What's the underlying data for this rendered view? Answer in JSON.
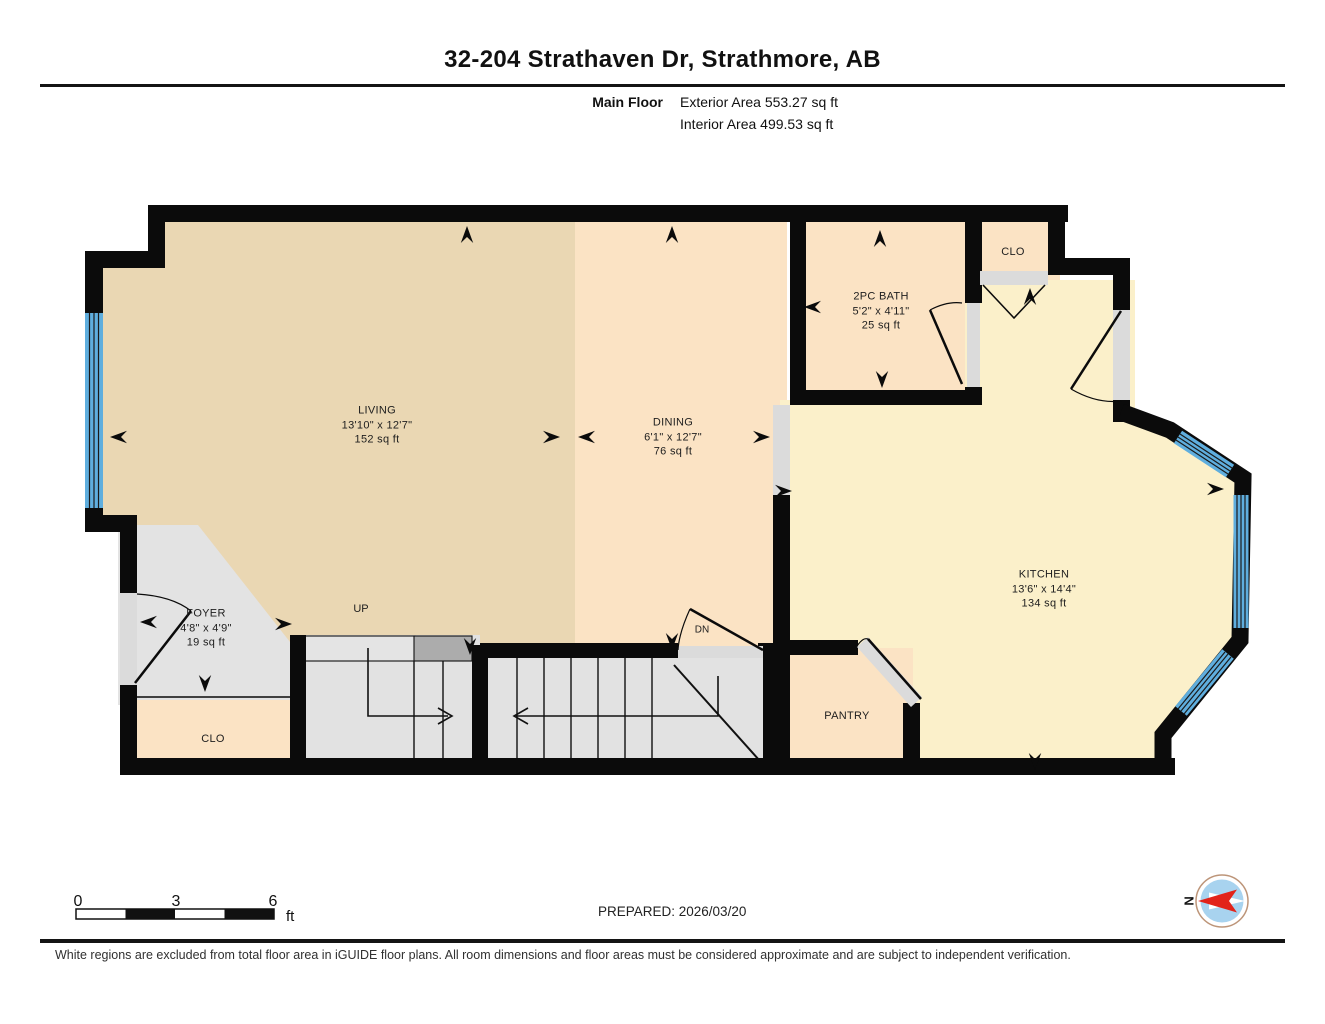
{
  "header": {
    "title": "32-204 Strathaven Dr, Strathmore, AB",
    "floor_label": "Main Floor",
    "exterior_area": "Exterior Area 553.27 sq ft",
    "interior_area": "Interior Area 499.53 sq ft"
  },
  "rooms": {
    "living": {
      "name": "LIVING",
      "dims": "13'10\" x 12'7\"",
      "area": "152 sq ft"
    },
    "dining": {
      "name": "DINING",
      "dims": "6'1\" x 12'7\"",
      "area": "76 sq ft"
    },
    "bath": {
      "name": "2PC BATH",
      "dims": "5'2\" x 4'11\"",
      "area": "25 sq ft"
    },
    "kitchen": {
      "name": "KITCHEN",
      "dims": "13'6\" x 14'4\"",
      "area": "134 sq ft"
    },
    "foyer": {
      "name": "FOYER",
      "dims": "4'8\" x 4'9\"",
      "area": "19 sq ft"
    },
    "closet_top": {
      "name": "CLO"
    },
    "closet_entry": {
      "name": "CLO"
    },
    "pantry": {
      "name": "PANTRY"
    }
  },
  "stairs": {
    "up_label": "UP",
    "down_label": "DN"
  },
  "scale_bar": {
    "tick_labels": [
      "0",
      "3",
      "6"
    ],
    "unit_label": "ft"
  },
  "prepared_label": "PREPARED: 2026/03/20",
  "compass": {
    "north_label": "N"
  },
  "footer": {
    "disclaimer": "White regions are excluded from total floor area in iGUIDE floor plans. All room dimensions and floor areas must be considered approximate and are subject to independent verification."
  },
  "colors": {
    "wall": "#0b0b0b",
    "living_fill": "#EAD7B3",
    "dining_fill": "#FBE3C4",
    "kitchen_fill": "#FBF0CA",
    "gray_fill": "#E3E3E3",
    "threshold_gray": "#DBDBDB",
    "step_dark_gray": "#ACACAC",
    "window_blue": "#5FAEDE",
    "compass_blue": "#A8D3EF",
    "compass_red": "#E2231A",
    "compass_ring": "#BD9579"
  }
}
